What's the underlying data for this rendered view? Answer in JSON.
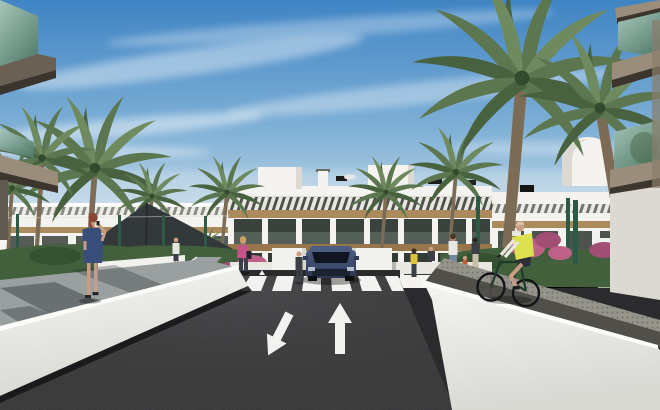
{
  "meta": {
    "type": "architectural-rendering",
    "description": "3D render of a modern white Mediterranean apartment complex street: palm trees, dark asphalt road with zebra crosswalk and two lane arrows, pedestrians on walkways, a cyclist in a yellow hi-vis vest, white barrier walls, foreground balconies with teal glass at both edges."
  },
  "palette": {
    "sky_top": "#3f84c4",
    "sky_mid": "#7fb0d6",
    "sky_horizon": "#cfdfe9",
    "cloud_white": "#ffffff",
    "building_white": "#f4f3ef",
    "building_shade": "#dcd9d2",
    "opening_dark": "#3a423e",
    "opening_darker": "#333b37",
    "balustrade_glass": "#74847b",
    "wood_tan": "#ab8a5c",
    "wood_dark": "#97764b",
    "slat_dark": "#4e5349",
    "slat_light": "#e8e6e0",
    "glass_teal_light": "#a6c6b9",
    "glass_teal_dark": "#57806f",
    "slab_tan": "#9b8d7b",
    "slab_brown": "#6b6054",
    "slab_underside": "#3c352e",
    "palm_green": "#5c7750",
    "palm_green_light": "#6f8a5f",
    "palm_green_dark": "#48613e",
    "trunk_brown": "#7c6c56",
    "hedge_green": "#42603c",
    "hedge_dark": "#324a2e",
    "fence_green": "#2d5a44",
    "flower_pink": "#bd6286",
    "flower_pink_dark": "#a04e73",
    "asphalt": "#2b2b2d",
    "asphalt_light": "#47474b",
    "marking_white": "#f2f2f0",
    "walkway_gray": "#9aa0a0",
    "shadow_dark": "#23282a",
    "wall_bright": "#fcfcfa",
    "wall_white": "#f1f1ee",
    "wall_shade": "#d7d7d2",
    "paving_light": "#e4e3df",
    "tactile_gray": "#95948a",
    "path_dark": "#514f49",
    "sail_dark": "#33383b",
    "car_body_top": "#4d5e83",
    "car_body": "#36486a",
    "car_body_dark": "#2a3550",
    "car_glass": "#10151f",
    "skin": "#c79d85",
    "dress_blue": "#3a4e7a",
    "hair_auburn": "#8a4630",
    "hair_blonde": "#c9a35f",
    "top_pink": "#c4538a",
    "pants_dark": "#3b3f48",
    "shirt_white": "#e9e7e1",
    "jeans_blue": "#7187a0",
    "vest_yellow": "#dce24f",
    "top_yellow": "#d8c43f",
    "child_orange": "#c05a36",
    "dark_figure": "#3c4046"
  },
  "scene": {
    "elements": [
      {
        "id": "sky",
        "label": "blue sky with wispy cirrus clouds"
      },
      {
        "id": "apartment-building-center",
        "label": "white 3-storey apartment block with slatted sun shades, wood pergola bands and dark balcony openings"
      },
      {
        "id": "apartment-building-left-wing",
        "label": "lower white building wing on the left"
      },
      {
        "id": "apartment-building-right-wing",
        "label": "white building wing with barrel-vault penthouse on the right"
      },
      {
        "id": "rooftop-equipment",
        "label": "chimneys, vents and satellite dish on the roofline"
      },
      {
        "id": "palm-trees",
        "label": "ten palm trees of varying size flanking the street"
      },
      {
        "id": "shade-sail",
        "label": "dark triangular shade sail on the left"
      },
      {
        "id": "hedges-and-flowers",
        "label": "green hedges with pink bougainvillea"
      },
      {
        "id": "green-fence",
        "label": "dark green fence posts along both sidewalks"
      },
      {
        "id": "road",
        "label": "dark asphalt road receding toward the buildings"
      },
      {
        "id": "crosswalk",
        "label": "white zebra crosswalk with two small yield arrows"
      },
      {
        "id": "lane-arrow-forward",
        "label": "white arrow pointing away (up)"
      },
      {
        "id": "lane-arrow-turn",
        "label": "white arrow pointing down-left toward viewer"
      },
      {
        "id": "car-suv",
        "label": "dark blue SUV facing the viewer beyond the crosswalk"
      },
      {
        "id": "pedestrian-blue-dress",
        "label": "red-haired woman in a blue dress walking on the left walkway"
      },
      {
        "id": "pedestrian-pink-top",
        "label": "blonde woman in pink top with handbag near the flower bed"
      },
      {
        "id": "pedestrian-white-shirt",
        "label": "distant man in white shirt on the left path"
      },
      {
        "id": "pedestrian-dark-jacket",
        "label": "man in dark clothes beside the left planter"
      },
      {
        "id": "pedestrian-group-right",
        "label": "family group walking on the right sidewalk"
      },
      {
        "id": "cyclist-yellow-vest",
        "label": "cyclist with yellow hi-vis vest riding the right-hand path"
      },
      {
        "id": "left-barrier-wall",
        "label": "white diagonal barrier wall between walkway and road, bottom left"
      },
      {
        "id": "right-ramp-wall",
        "label": "large white ramp wall with tactile paving strip, bottom right"
      },
      {
        "id": "foreground-balcony-left",
        "label": "close-up balcony corner with teal glass, top-left edge"
      },
      {
        "id": "foreground-balcony-right",
        "label": "close-up balconies with teal glass and tan slabs, right edge"
      }
    ]
  }
}
